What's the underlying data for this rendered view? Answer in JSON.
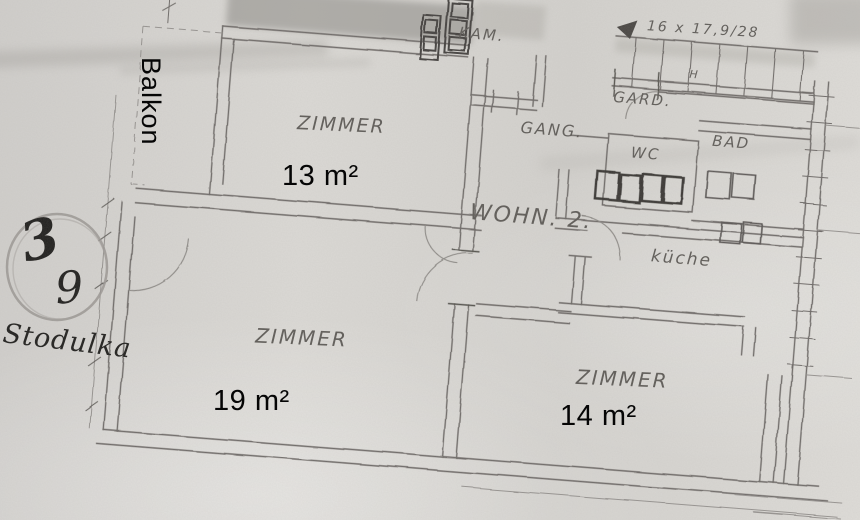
{
  "plan": {
    "balcony": {
      "label": "Balkon"
    },
    "rooms": [
      {
        "label": "ZIMMER",
        "size": "13 m²"
      },
      {
        "label": "ZIMMER",
        "size": "19 m²"
      },
      {
        "label": "ZIMMER",
        "size": "14 m²"
      }
    ],
    "areas": {
      "kam": "KAM.",
      "gang": "GANG.",
      "gard": "GARD.",
      "wc": "WC",
      "bad": "BAD",
      "wohn": "WOHN. 2.",
      "kueche": "küche"
    },
    "stairs": {
      "note": "16 x 17,9/28"
    },
    "marks": {
      "h": "H"
    },
    "annotation": {
      "circled_number": "3",
      "secondary_number": "9",
      "name": "Stodulka"
    }
  },
  "colors": {
    "paper": "#d7d5d1",
    "pencil": "#6e6b67",
    "pencil_dark": "#44423f",
    "ink": "#21201e",
    "overlay_text": "#000000"
  }
}
